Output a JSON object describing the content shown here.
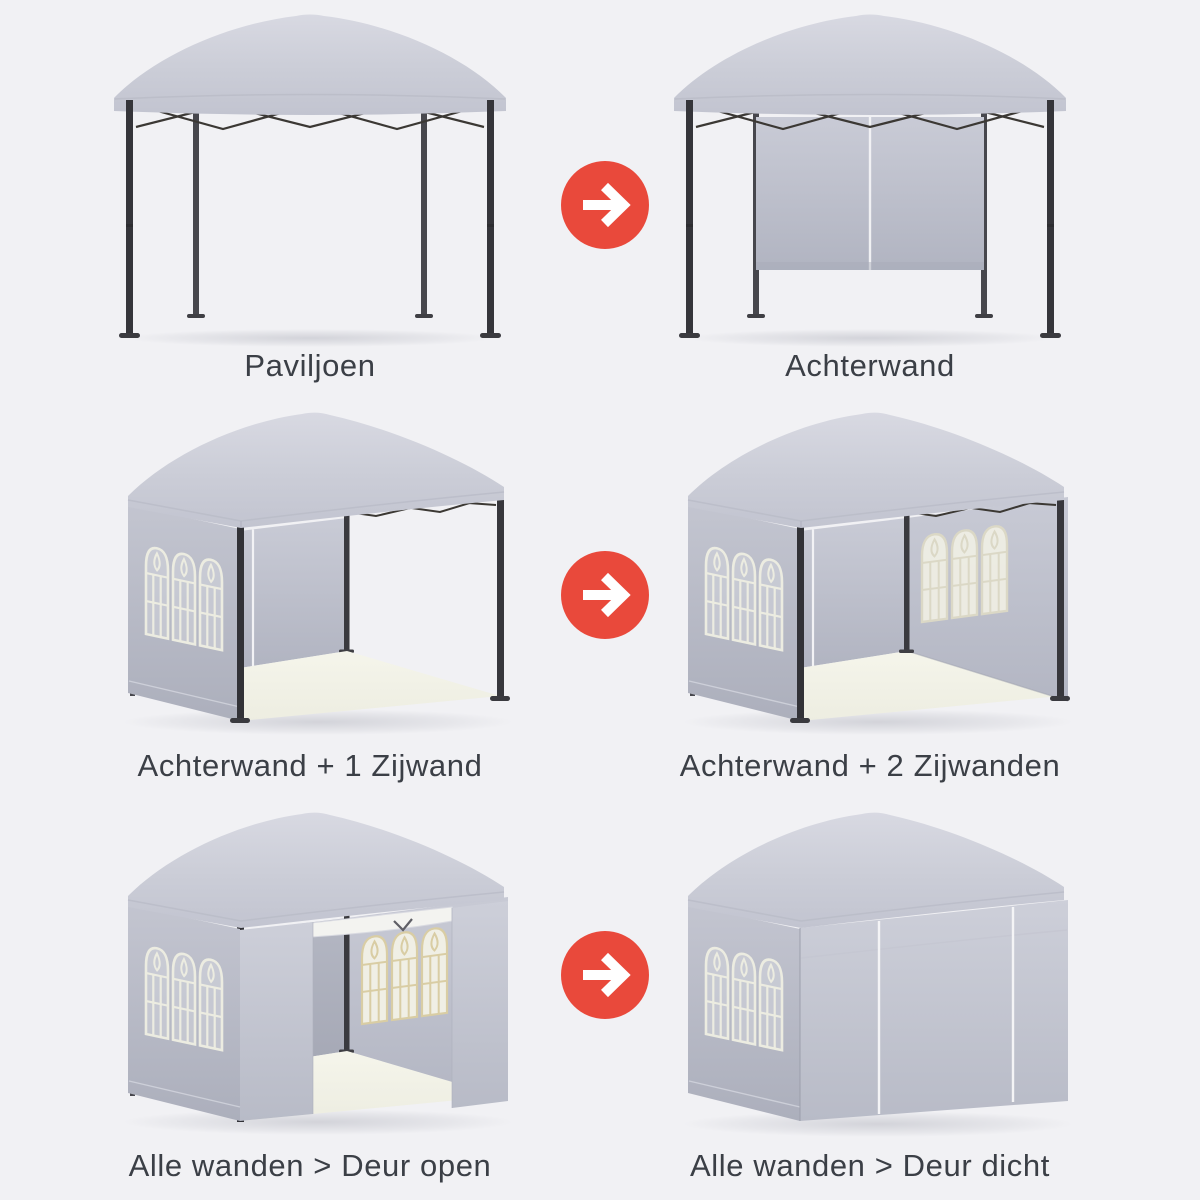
{
  "page": {
    "type": "product-infographic",
    "language": "nl",
    "subject": "partytent / paviljoen opbouw-varianten"
  },
  "colors": {
    "page_bg": "#F1F1F4",
    "label_text": "#3B3F46",
    "arrow_red": "#E9493B",
    "arrow_glyph": "#FFFFFF",
    "canopy_grey": "#CBCDD7",
    "wall_grey": "#B4B7C3",
    "frame_dark": "#35353A",
    "window_cream": "#ECECE1",
    "floor_cream": "#F1F1E6",
    "seam_white": "#F3F3F6"
  },
  "arrow": {
    "icon": "arrow-right-icon",
    "shape": "white right arrow in red circle"
  },
  "rows": [
    {
      "before": {
        "label": "Paviljoen",
        "illustration": "pavilion-frame-open"
      },
      "after": {
        "label": "Achterwand",
        "illustration": "pavilion-with-back-wall"
      }
    },
    {
      "before": {
        "label": "Achterwand + 1 Zijwand",
        "illustration": "pavilion-back-wall-one-side-wall"
      },
      "after": {
        "label": "Achterwand + 2 Zijwanden",
        "illustration": "pavilion-back-wall-two-side-walls"
      }
    },
    {
      "before": {
        "label": "Alle wanden > Deur open",
        "illustration": "pavilion-all-walls-door-open"
      },
      "after": {
        "label": "Alle wanden > Deur dicht",
        "illustration": "pavilion-all-walls-door-closed"
      }
    }
  ]
}
